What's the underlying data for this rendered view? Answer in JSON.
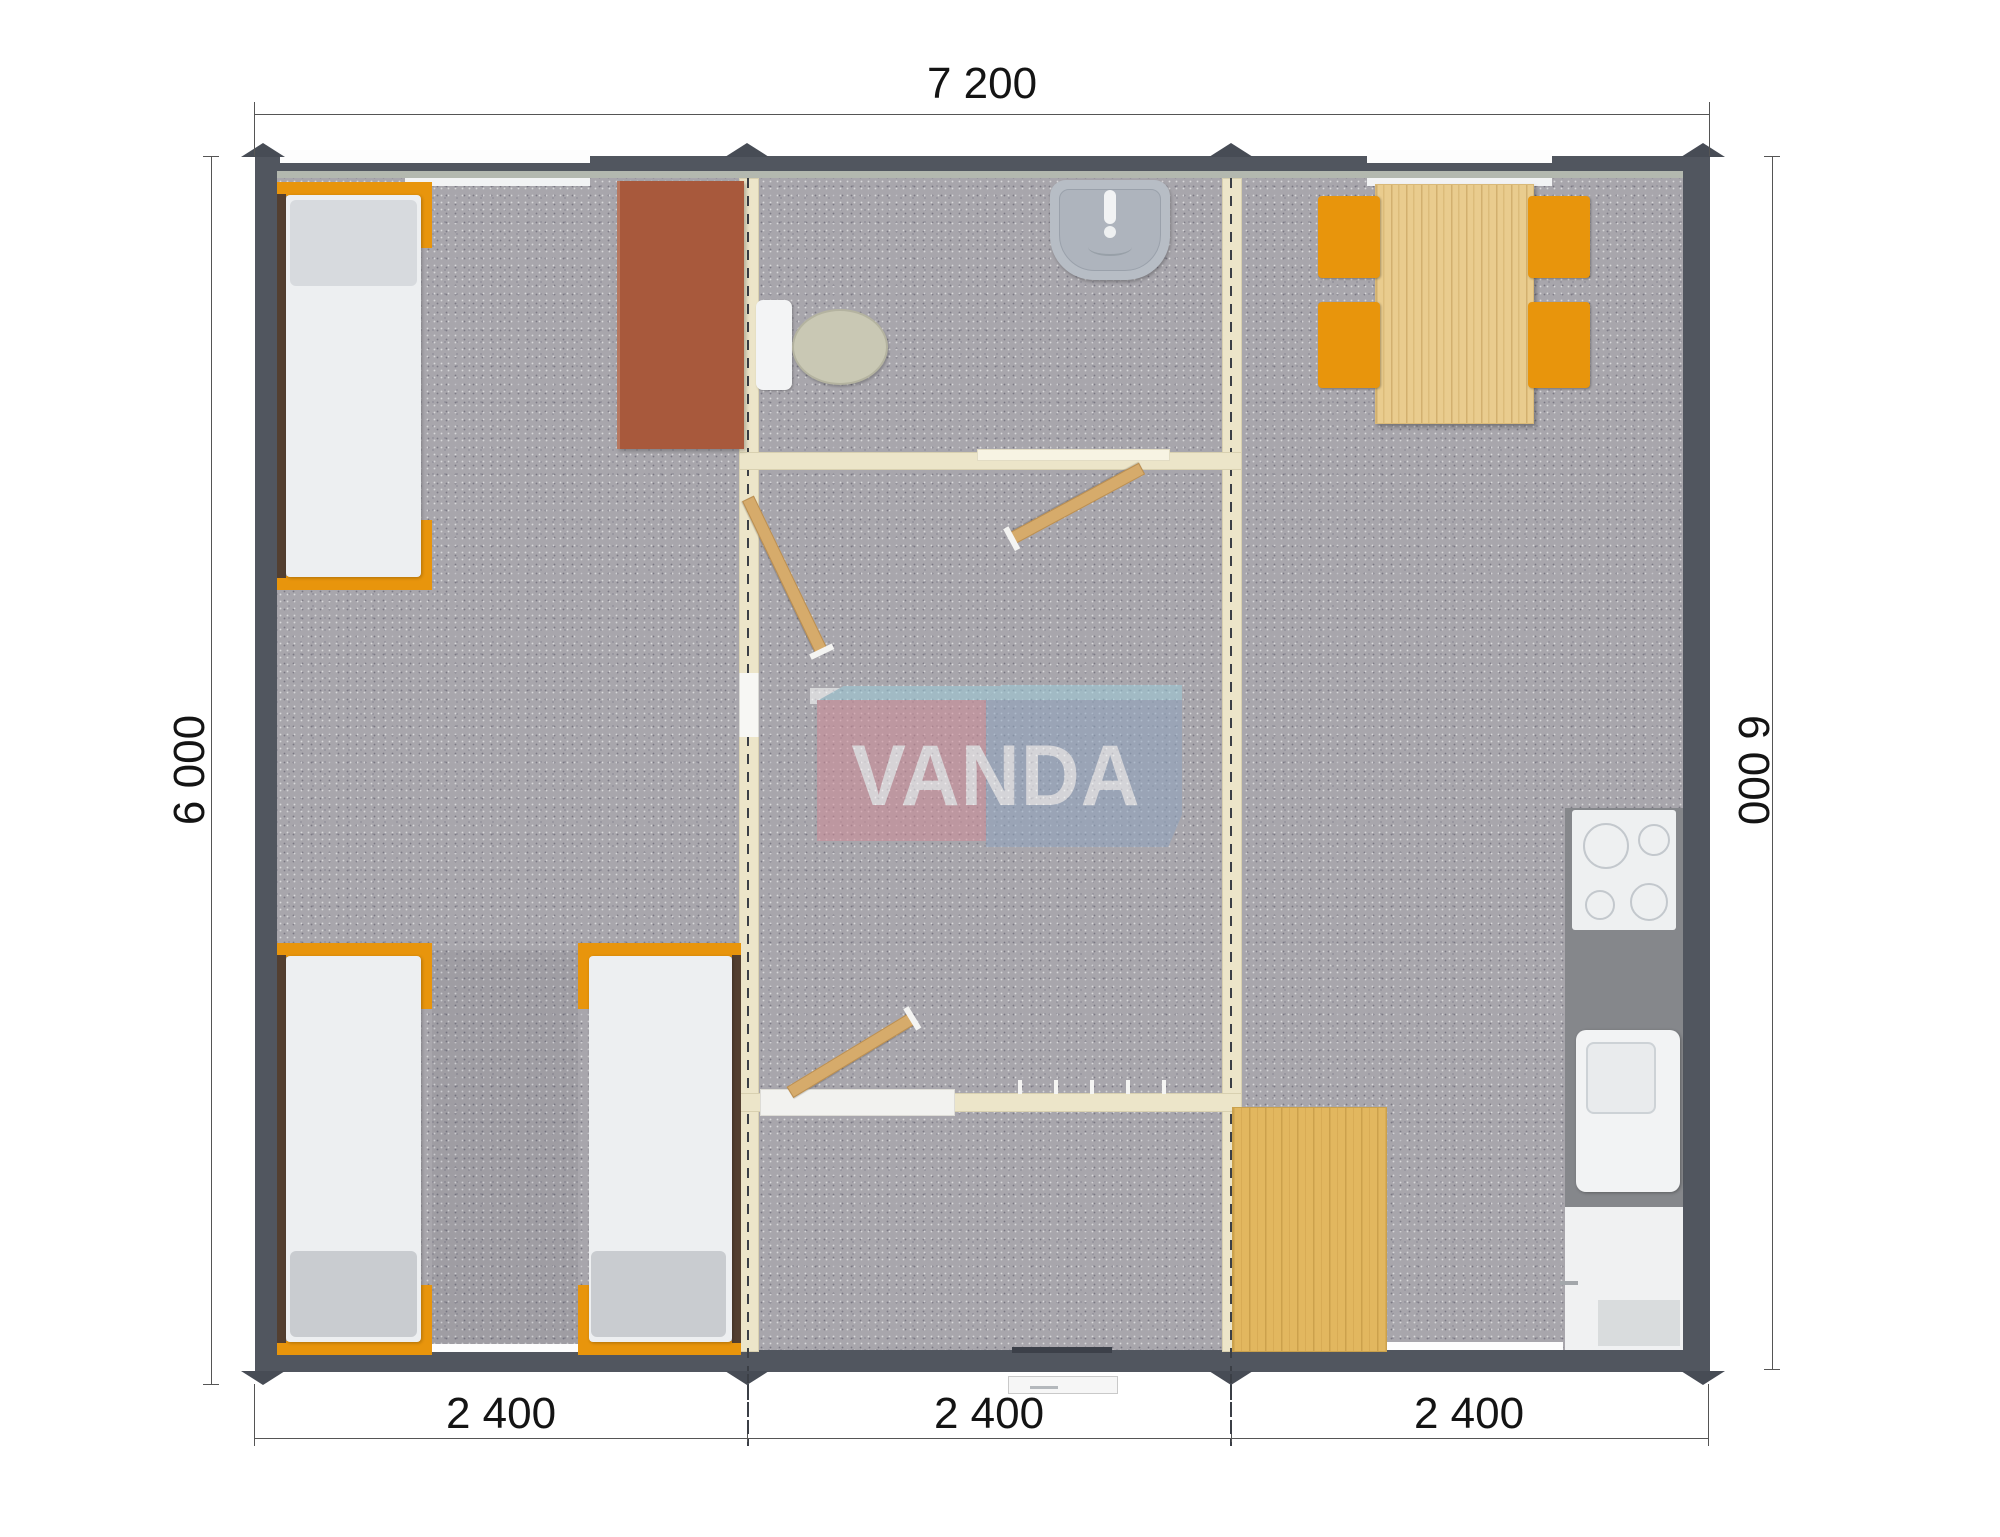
{
  "watermark": {
    "text": "VANDA"
  },
  "dimensions": {
    "top": {
      "label": "7 200"
    },
    "left": {
      "label": "6 000"
    },
    "right": {
      "label": "6 000"
    },
    "bottom": {
      "module1": "2 400",
      "module2": "2 400",
      "module3": "2 400"
    }
  },
  "furniture": {
    "left_module": [
      "single-bed",
      "single-bed",
      "single-bed",
      "desk"
    ],
    "middle_module": [
      "toilet",
      "washbasin",
      "door",
      "door",
      "door",
      "coat-hooks",
      "entrance-step"
    ],
    "right_module": [
      "dining-table",
      "chair",
      "chair",
      "chair",
      "chair",
      "stove",
      "kitchen-sink",
      "cabinet",
      "floor-mat"
    ]
  },
  "colors": {
    "wall": "#51565f",
    "floor": "#a8a6ac",
    "liner": "#b3b8af",
    "partition": "#ece5c9",
    "partition-edge": "#d8d0b0",
    "orange": "#e8950c",
    "wood": "#e9cc8e",
    "mat": "#e2b75f",
    "door": "#d6ab6b",
    "desk": "#a8593c",
    "mattress": "#edeff1",
    "pillow": "#d7dade",
    "footrest": "#c9ccd0",
    "rail": "#533f30",
    "seat": "#c9c8b4",
    "sink": "#b7bdc5",
    "counter": "#85878b",
    "logo-pink": "#cf8b97",
    "logo-blue": "#8fa4bf",
    "logo-cyan": "#9ccbd9"
  }
}
